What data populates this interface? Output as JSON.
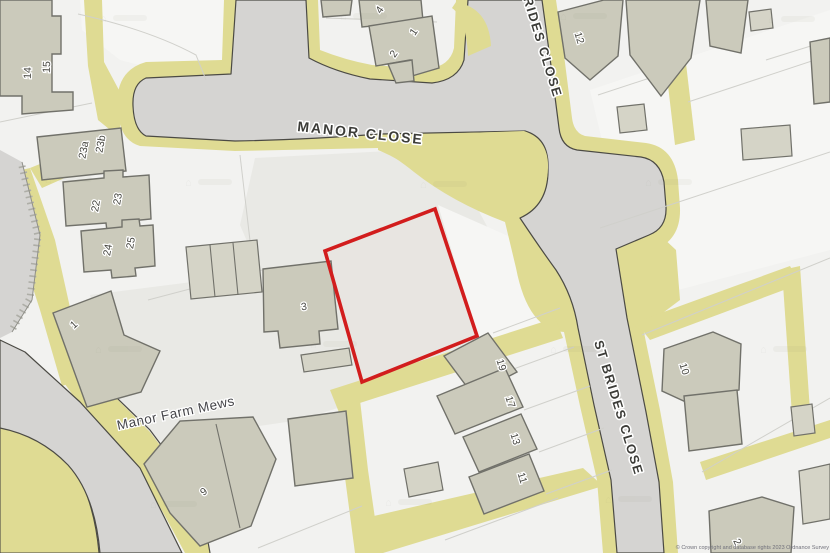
{
  "map": {
    "streets": {
      "manor_close": "MANOR CLOSE",
      "st_brides_close_upper": "BRIDES CLOSE",
      "st_brides_close_lower": "ST BRIDES CLOSE",
      "manor_farm_mews": "Manor Farm Mews"
    },
    "house_numbers": {
      "n14": "14",
      "n15": "15",
      "n23a": "23a",
      "n23b": "23b",
      "n22": "22",
      "n23": "23",
      "n24": "24",
      "n25": "25",
      "n1_west": "1",
      "n3": "3",
      "n9": "9",
      "n19": "19",
      "n17": "17",
      "n13": "13",
      "n11": "11",
      "n12": "12",
      "n10": "10",
      "n4_north": "4",
      "n1_north": "1",
      "n2_north": "2",
      "n2_southeast": "2"
    },
    "attribution": "© Crown copyright and database rights 2023 Ordnance Survey",
    "colors": {
      "bg": "#f2f2f0",
      "plot": "#f6f6f4",
      "plot_shade": "#e9e9e5",
      "road": "#d5d4d2",
      "road_casing": "#4b4a44",
      "verge": "#dfdb93",
      "building": "#cbcabb",
      "building_light": "#d5d4c7",
      "building_stroke": "#71716a",
      "parcel_line": "#d0d0cb",
      "boundary_red": "#d21d1d",
      "label_dark": "#3c3c38"
    }
  }
}
